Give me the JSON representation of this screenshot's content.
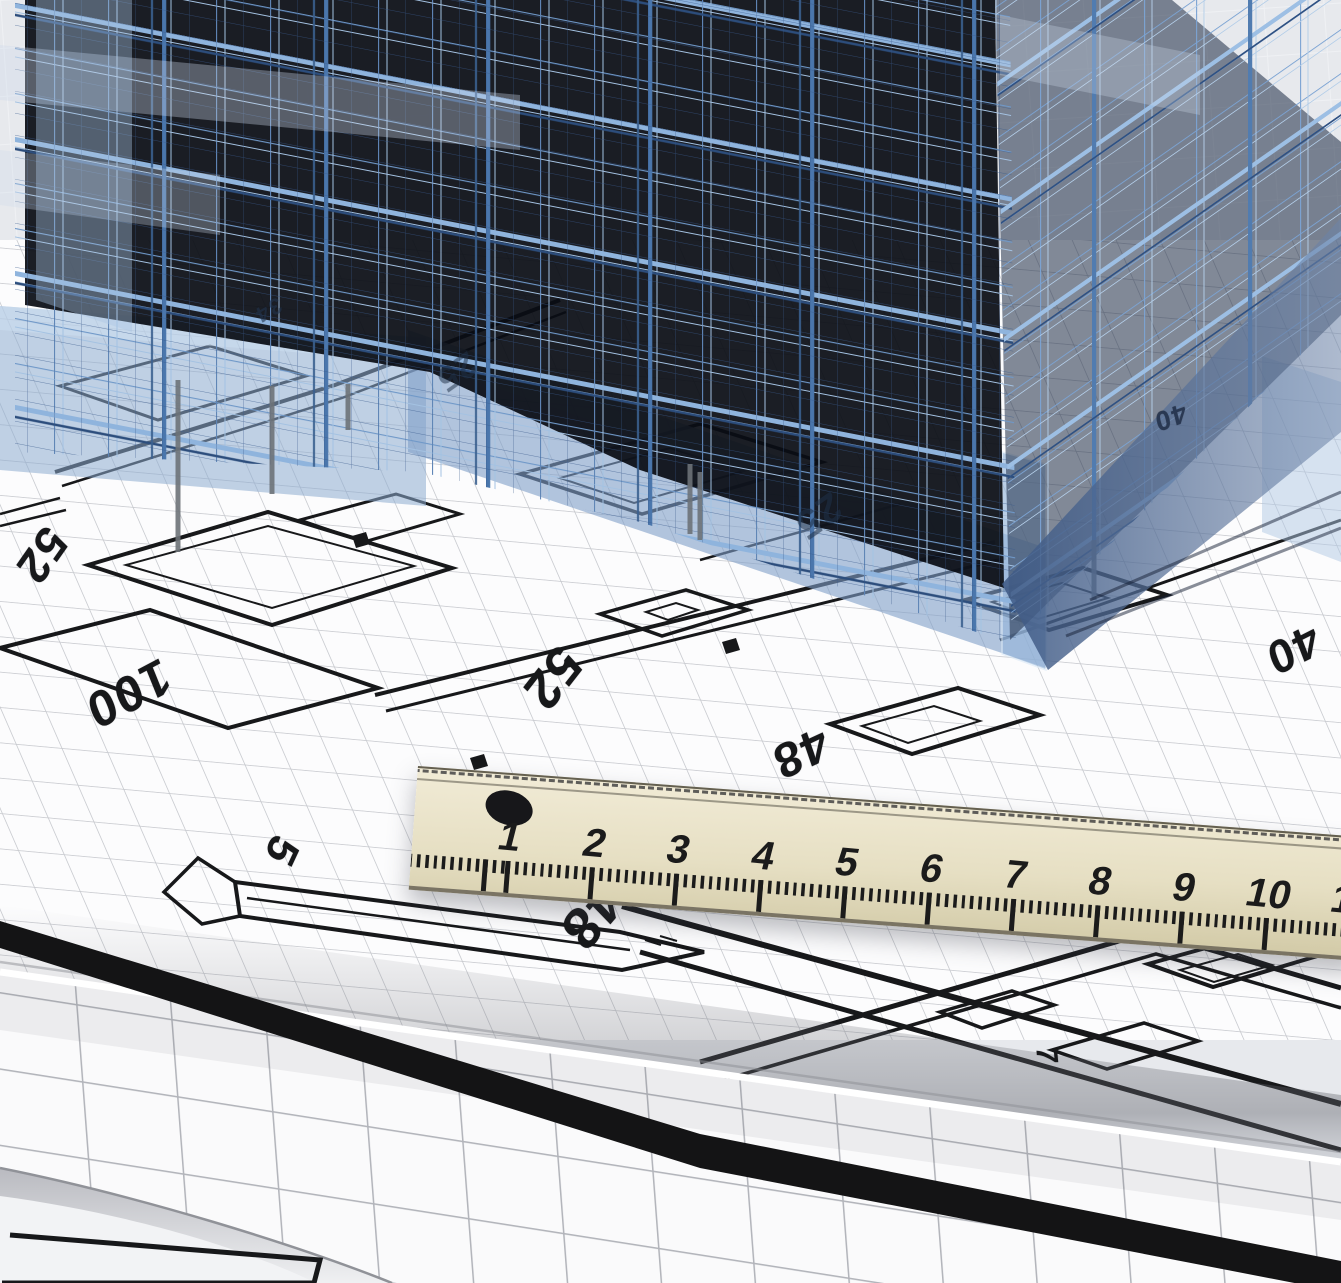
{
  "plan_annotations": [
    {
      "text": "52",
      "x": 42,
      "y": 556,
      "rot": 125,
      "size": 46
    },
    {
      "text": "100",
      "x": 128,
      "y": 694,
      "rot": 152,
      "size": 50
    },
    {
      "text": "52",
      "x": 552,
      "y": 678,
      "rot": 128,
      "size": 52
    },
    {
      "text": "48",
      "x": 800,
      "y": 752,
      "rot": 155,
      "size": 48
    },
    {
      "text": "40",
      "x": 1293,
      "y": 650,
      "rot": 153,
      "size": 46
    },
    {
      "text": "40",
      "x": 1170,
      "y": 417,
      "rot": 160,
      "size": 27,
      "color": "#202e47",
      "opacity": 0.85
    },
    {
      "text": "25",
      "x": 818,
      "y": 516,
      "rot": 145,
      "size": 40,
      "color": "#1e3048",
      "opacity": 0.55
    },
    {
      "text": "25",
      "x": 456,
      "y": 372,
      "rot": 145,
      "size": 34,
      "color": "#1e3048",
      "opacity": 0.5
    },
    {
      "text": "34",
      "x": 268,
      "y": 310,
      "rot": 150,
      "size": 22,
      "color": "#20334c",
      "opacity": 0.6
    },
    {
      "text": "5",
      "x": 281,
      "y": 851,
      "rot": 115,
      "size": 44
    },
    {
      "text": "48",
      "x": 592,
      "y": 916,
      "rot": 130,
      "size": 56
    },
    {
      "text": "7",
      "x": 1046,
      "y": 1056,
      "rot": 85,
      "size": 30
    }
  ],
  "ruler": {
    "numbers": [
      "1",
      "2",
      "3",
      "4",
      "5",
      "6",
      "7",
      "8",
      "9",
      "10",
      "11"
    ]
  },
  "colors": {
    "background": "#e7e9ed",
    "background_grid": "#f3f4f7",
    "blueprint_paper": "#fcfcfd",
    "blueprint_grid": "#c7c9ce",
    "plan_line": "#17181a",
    "building_dark": "#0a0d14",
    "wireframe_blue": "#4a76ac",
    "wireframe_light_blue": "#8fb4dd",
    "glass_slab": "#7f9fc8",
    "cast_shadow": "#45608a",
    "ruler_wood": "#e6dfc3",
    "ruler_marking": "#1b1b1b",
    "roll_paper": "#fafafb",
    "roll_grid": "#b3b5bb"
  }
}
